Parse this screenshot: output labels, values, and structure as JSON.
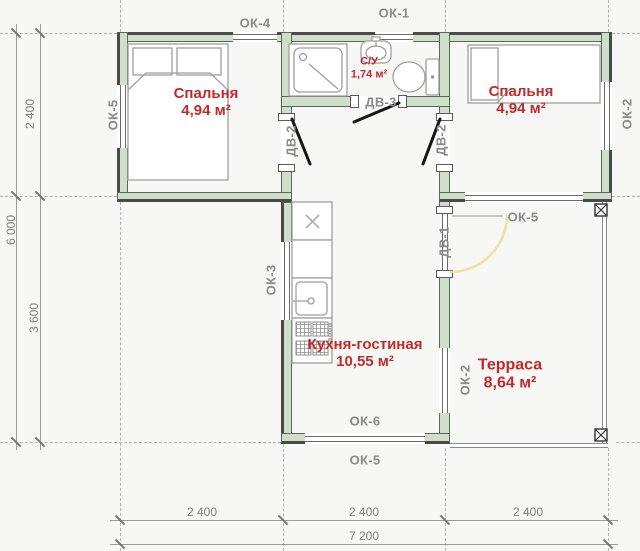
{
  "rooms": {
    "bedroom_left": {
      "name": "Спальня",
      "area": "4,94 м²"
    },
    "bedroom_right": {
      "name": "Спальня",
      "area": "4,94 м²"
    },
    "bathroom": {
      "name": "С/У",
      "area": "1,74 м²"
    },
    "kitchen_living": {
      "name": "Кухня-гостиная",
      "area": "10,55 м²"
    },
    "terrace": {
      "name": "Терраса",
      "area": "8,64 м²"
    }
  },
  "openings": {
    "ok1": "ОК-1",
    "ok2": "ОК-2",
    "ok3": "ОК-3",
    "ok4": "ОК-4",
    "ok5": "ОК-5",
    "ok6": "ОК-6",
    "dv1": "ДВ-1",
    "dv2": "ДВ-2",
    "dv3": "ДВ-3"
  },
  "dimensions": {
    "left": {
      "upper": "2 400",
      "lower": "3 600",
      "total": "6 000"
    },
    "bottom": {
      "seg1": "2 400",
      "seg2": "2 400",
      "seg3": "2 400",
      "total": "7 200"
    }
  },
  "colors": {
    "bg": "#f7f7f5",
    "wall_fill": "#cfdfca",
    "wall_line": "#5d665c",
    "wall_edge": "#4a4a4a",
    "window_line": "#6a6a6a",
    "furniture_line": "#9f9f9f",
    "label_gray": "#8a8a8a",
    "dim_gray": "#7d7d7d",
    "room_red": "#c22a2a",
    "door_black": "#161616",
    "arc_yellow": "#e8e09a",
    "axis_gray": "#b5b5b5"
  }
}
